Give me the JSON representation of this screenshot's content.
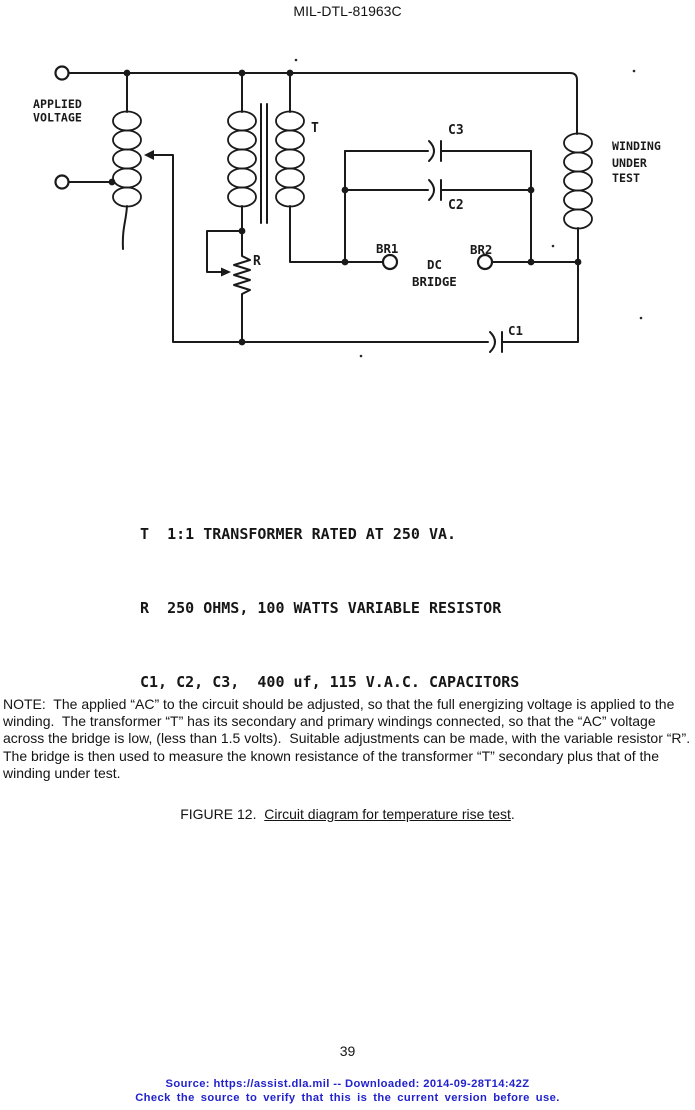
{
  "page": {
    "header_title": "MIL-DTL-81963C",
    "page_number": "39",
    "footer": {
      "line1": "Source: https://assist.dla.mil -- Downloaded: 2014-09-28T14:42Z",
      "line2": "Check the source to verify that this is the current version before use.",
      "color": "#2222cc"
    }
  },
  "diagram": {
    "labels": {
      "applied_voltage_1": "APPLIED",
      "applied_voltage_2": "VOLTAGE",
      "transformer": "T",
      "c3": "C3",
      "c2": "C2",
      "c1": "C1",
      "br1": "BR1",
      "br2": "BR2",
      "dc_bridge_1": "DC",
      "dc_bridge_2": "BRIDGE",
      "resistor": "R",
      "winding_1": "WINDING",
      "winding_2": "UNDER",
      "winding_3": "TEST"
    },
    "legend": [
      "T  1:1 TRANSFORMER RATED AT 250 VA.",
      "R  250 OHMS, 100 WATTS VARIABLE RESISTOR",
      "C1, C2, C3,  400 uf, 115 V.A.C. CAPACITORS"
    ]
  },
  "note": {
    "text": "NOTE:  The applied “AC” to the circuit should be adjusted, so that the full energizing voltage is applied to the winding.  The transformer “T” has its secondary and primary windings connected, so that the “AC” voltage across the bridge is low, (less than 1.5 volts).  Suitable adjustments can be made, with the variable resistor “R”.  The bridge is then used to measure the known resistance of the transformer “T” secondary plus that of the winding under test."
  },
  "caption": {
    "prefix": "FIGURE 12.  ",
    "underlined": "Circuit diagram for temperature rise test",
    "suffix": "."
  }
}
